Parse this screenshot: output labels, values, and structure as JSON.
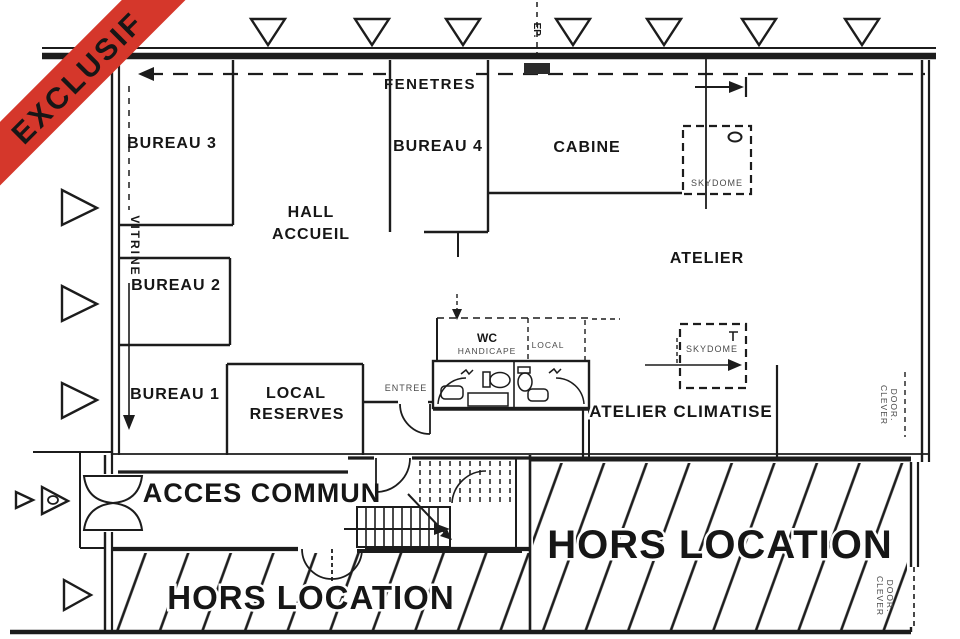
{
  "banner": {
    "label": "EXCLUSIF",
    "color": "#d5372b"
  },
  "rooms": {
    "bureau3": "BUREAU 3",
    "bureau2": "BUREAU 2",
    "bureau1": "BUREAU 1",
    "bureau4": "BUREAU 4",
    "cabine": "CABINE",
    "hall_line1": "HALL",
    "hall_line2": "ACCUEIL",
    "atelier": "ATELIER",
    "reserves_line1": "LOCAL",
    "reserves_line2": "RESERVES",
    "atelier_climatise": "ATELIER CLIMATISE",
    "acces_commun": "ACCES COMMUN",
    "hors_location_left": "HORS LOCATION",
    "hors_location_right": "HORS LOCATION"
  },
  "labels": {
    "fenetres": "FENETRES",
    "ep": "EP.",
    "vitrine": "VITRINE",
    "entree": "ENTREE",
    "wc": "WC",
    "handicape": "HANDICAPE",
    "local_small": "LOCAL",
    "skydome1": "SKYDOME",
    "skydome2": "SKYDOME",
    "clever1_line1": "CLEVER",
    "clever1_line2": "DOOR.",
    "clever2_line1": "CLEVER",
    "clever2_line2": "DOOR."
  }
}
